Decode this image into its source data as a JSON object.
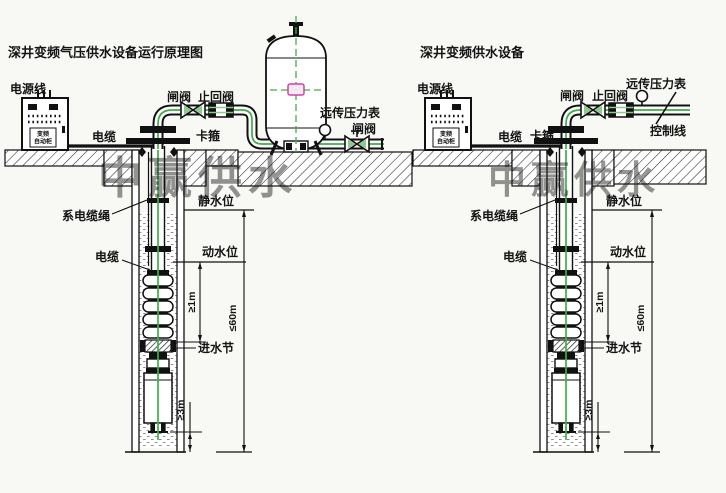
{
  "watermark": {
    "text": "中赢供水",
    "color": "#ff4a4a"
  },
  "left_diagram": {
    "title": "深井变频气压供水设备运行原理图",
    "outlet_valve_label": "闸阀"
  },
  "right_diagram": {
    "title": "深井变频供水设备",
    "control_line_label": "控制线"
  },
  "shared": {
    "power_line": "电源线",
    "cabinet_line1": "变频",
    "cabinet_line2": "自动柜",
    "surface_cable": "电缆",
    "gate_valve": "闸阀",
    "check_valve": "止回阀",
    "clamp": "卡箍",
    "remote_gauge": "远传压力表"
  },
  "well": {
    "tie_rope": "系电缆绳",
    "cable": "电缆",
    "static_level": "静水位",
    "dynamic_level": "动水位",
    "inlet_section": "进水节",
    "dim_min_1m": "≥1m",
    "dim_max_60m": "≤60m",
    "dim_min_3m": "≥3m"
  },
  "colors": {
    "pipe_green": "#3fae46",
    "watermark_red": "#ff4a4a",
    "tank_center_magenta": "#cc44aa"
  }
}
